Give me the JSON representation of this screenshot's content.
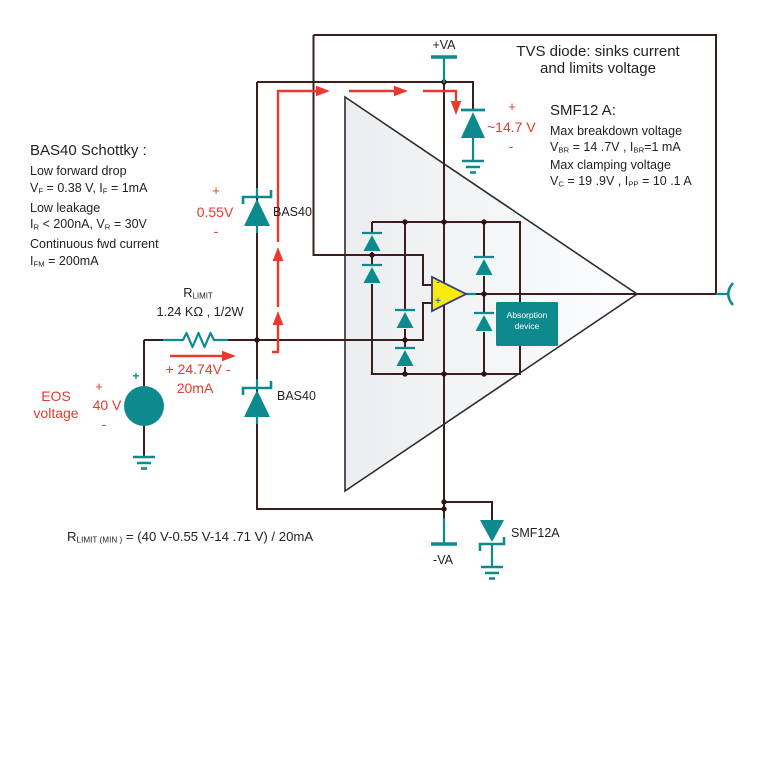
{
  "colors": {
    "wire": "#3b1f1f",
    "dot": "#2c1414",
    "teal": "#0d8a8e",
    "red": "#e8392d",
    "opamp_fill": "#f7ea0c",
    "opamp_outline": "#34398b",
    "text": "#231f20",
    "triangle_fill_left": "#ebedf0",
    "triangle_fill_right": "#fcfdfe"
  },
  "power": {
    "vplus": "+VA",
    "vminus": "-VA"
  },
  "tvs_note": {
    "line1": "TVS diode: sinks current",
    "line2": "and limits voltage"
  },
  "smf12_note": {
    "title": "SMF12 A:",
    "line1": "Max breakdown voltage",
    "line2": [
      {
        "t": "V"
      },
      {
        "t": "BR",
        "sub": true
      },
      {
        "t": " = 14 .7V , I"
      },
      {
        "t": "BR",
        "sub": true
      },
      {
        "t": "=1 mA"
      }
    ],
    "line3": "Max clamping voltage",
    "line4": [
      {
        "t": "V"
      },
      {
        "t": "C",
        "sub": true
      },
      {
        "t": " = 19 .9V , I"
      },
      {
        "t": "PP",
        "sub": true
      },
      {
        "t": " = 10 .1 A"
      }
    ]
  },
  "bas40_note": {
    "title": "BAS40 Schottky   :",
    "lines": [
      [
        {
          "t": "Low forward drop"
        }
      ],
      [
        {
          "t": "V"
        },
        {
          "t": "F",
          "sub": true
        },
        {
          "t": " = 0.38 V, I"
        },
        {
          "t": "F",
          "sub": true
        },
        {
          "t": " = 1mA"
        }
      ],
      [
        {
          "t": "Low leakage"
        }
      ],
      [
        {
          "t": "I"
        },
        {
          "t": "R",
          "sub": true
        },
        {
          "t": " < 200nA,   V"
        },
        {
          "t": "R",
          "sub": true
        },
        {
          "t": " = 30V"
        }
      ],
      [
        {
          "t": "Continuous fwd current"
        }
      ],
      [
        {
          "t": "I"
        },
        {
          "t": "FM",
          "sub": true
        },
        {
          "t": " = 200mA"
        }
      ]
    ]
  },
  "resistor": {
    "name": [
      {
        "t": "R"
      },
      {
        "t": "LIMIT",
        "sub": true
      }
    ],
    "value": "1.24 KΩ , 1/2W"
  },
  "formula": [
    {
      "t": "R"
    },
    {
      "t": "LIMIT (MIN )",
      "sub": true
    },
    {
      "t": "  = (40 V-0.55 V-14 .71 V) / 20mA"
    }
  ],
  "diodes": {
    "bas40_top": "BAS40",
    "bas40_bottom": "BAS40",
    "smf12a": "SMF12A"
  },
  "red_labels": {
    "clamp055": {
      "plus": "+",
      "value": "0.55V",
      "minus": "-"
    },
    "clamp147": {
      "plus": "+",
      "value": "~14.7 V",
      "minus": "-"
    },
    "surge": {
      "value": "+ 24.74V -",
      "current": "20mA"
    },
    "eos": {
      "line1": "EOS",
      "line2": "voltage",
      "plus": "+",
      "value": "40 V",
      "minus": "-"
    }
  },
  "source": {
    "plus": "+"
  },
  "absorption": {
    "line1": "Absorption",
    "line2": "device"
  },
  "opamp": {
    "minus": "-",
    "plus": "+"
  }
}
